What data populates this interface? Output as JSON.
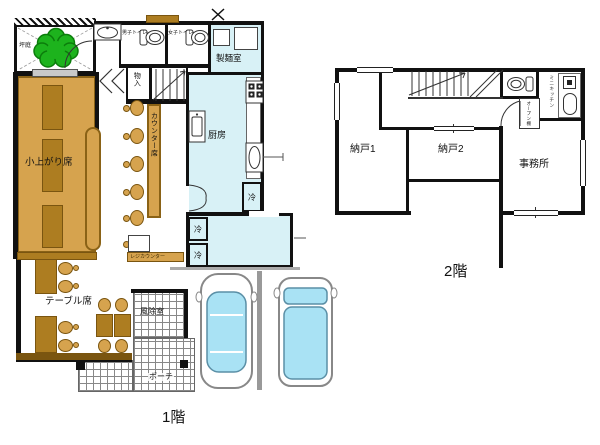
{
  "floor1": {
    "label": "1階",
    "rooms": {
      "tsuboniwa": "坪庭",
      "mens_toilet": "男子トイレ",
      "womens_toilet": "女子トイレ",
      "seimenshitsu": "製麺室",
      "monoire": "物入",
      "chubo": "厨房",
      "koagari": "小上がり席",
      "counter_seki": "カウンター席",
      "reji_counter": "レジカウンター",
      "table_seki": "テーブル席",
      "fujoshitsu": "風除室",
      "porch": "ポーチ",
      "rei": "冷"
    }
  },
  "floor2": {
    "label": "2階",
    "rooms": {
      "nando1": "納戸1",
      "nando2": "納戸2",
      "jimusho": "事務所",
      "open_dana": "オープン棚",
      "mini_kitchen": "ミニキッチン"
    }
  },
  "colors": {
    "wall": "#111111",
    "wood": "#D6A34E",
    "wood_dark": "#AD7D21",
    "room_aqua": "#D8F1F6",
    "tree_green": "#1DB31D",
    "car_glass": "#A9E2F4",
    "tile_line": "#888888"
  }
}
